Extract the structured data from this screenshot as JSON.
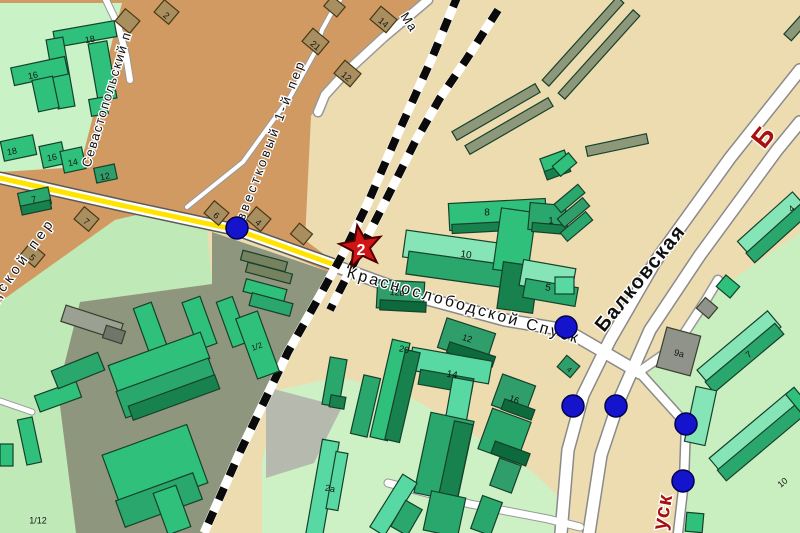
{
  "map": {
    "palette": {
      "beige": "#eddcb0",
      "orange": "#d29a63",
      "paleTL": "#c9f2c6",
      "paleBL": "#bfeab8",
      "olivezone": "#8e977d",
      "yard": "#cdf1c4",
      "graypatch": "#b5b9ae",
      "park": "#c9efc1",
      "bright": "#2fc17c",
      "mid": "#2aa76c",
      "mid2": "#2f9e6b",
      "dark": "#17824e",
      "deep": "#0d6a3c",
      "top": "#86e5b6",
      "mint": "#58d9a4",
      "olive": "#8d987b",
      "olive2": "#76815f",
      "grayb": "#9aa092",
      "gray2": "#8f938a",
      "gray3": "#70766a",
      "brown": "#a98f5f",
      "bldgStroke": "#16402b",
      "brownStroke": "#473a16",
      "rail": "#0a0a0a",
      "dotFill": "#1414cc",
      "dotStroke": "#00004d",
      "starFill": "#d11515",
      "starStroke": "#4d0000",
      "labelDark": "#101010",
      "labelRed": "#a80f0f",
      "roadYellow": "#ffe400"
    },
    "zones": [
      {
        "name": "base",
        "pts": "0,0 800,0 800,533 0,533",
        "fill": "beige"
      },
      {
        "name": "orange-quarter",
        "pts": "0,0 428,0 384,36 330,86 311,116 305,240 337,264 330,272 240,236 150,212 115,220 0,302",
        "fill": "orange"
      },
      {
        "name": "pale-green-top-left",
        "pts": "0,3 122,3 80,167 0,172",
        "fill": "paleTL"
      },
      {
        "name": "pale-green-bottom-left",
        "pts": "115,220 150,212 207,228 212,284 80,302 58,390 76,533 0,533 0,302",
        "fill": "paleBL"
      },
      {
        "name": "industrial-olive",
        "pts": "212,232 330,272 288,352 202,533 76,533 58,390 80,302 212,284",
        "fill": "olivezone"
      },
      {
        "name": "courtyard-green",
        "pts": "338,377 400,391 458,425 532,471 568,506 568,533 262,533 262,462 278,390",
        "fill": "yard"
      },
      {
        "name": "gray-lot",
        "pts": "266,387 342,407 314,463 266,478",
        "fill": "graypatch"
      },
      {
        "name": "park-green",
        "pts": "800,233 710,295 645,368 688,425 684,481 678,533 800,533",
        "fill": "park"
      }
    ],
    "roads": [
      {
        "name": "balkovskaya-left-lane",
        "pts": "800,70 730,158 655,262 610,340 583,395 568,450 561,533",
        "w": 11,
        "cw": 14,
        "casing": "#8a8a8a"
      },
      {
        "name": "balkovskaya-right-lane",
        "pts": "800,122 777,150 700,255 650,330 620,398 601,455 589,533",
        "w": 11,
        "cw": 14,
        "casing": "#8a8a8a"
      },
      {
        "name": "branch-northeast",
        "pts": "640,371 676,346 706,300 718,280",
        "w": 8,
        "cw": 11,
        "casing": "#999999"
      },
      {
        "name": "krasnoslobodskoy-spusk",
        "pts": "338,267 420,297 505,320 566,330 640,373",
        "w": 11,
        "cw": 14,
        "casing": "#8a8a8a"
      },
      {
        "name": "krasnoslobodskoy-ext",
        "pts": "640,373 686,424 684,481 678,533",
        "w": 8,
        "cw": 11,
        "casing": "#8a8a8a"
      },
      {
        "name": "yard-road",
        "pts": "388,483 470,504 548,519 580,527",
        "w": 7,
        "cw": 9,
        "casing": "#999999"
      },
      {
        "name": "gorodskoy-per-yellow",
        "pts": "0,178 120,205 237,230 338,266",
        "w": 10,
        "cw": 13,
        "casing": "#5a5a5a",
        "center": {
          "color": "roadYellow",
          "w": 5
        }
      },
      {
        "name": "izvestkovy-per",
        "pts": "187,207 243,162 290,97 315,52 322,30 333,10 340,0",
        "w": 4,
        "cw": 6,
        "casing": "#999999"
      },
      {
        "name": "ma-street",
        "pts": "428,0 383,38 345,73 325,95 318,112",
        "w": 8,
        "cw": 11,
        "casing": "#999999"
      },
      {
        "name": "stub-west",
        "pts": "0,401 32,412",
        "w": 5,
        "cw": 7,
        "casing": "#999999"
      },
      {
        "name": "sevastopolsky-top",
        "pts": "106,0 118,25 126,55 130,80",
        "w": 6,
        "cw": 8,
        "casing": "#999999"
      }
    ],
    "railways": [
      {
        "name": "railway-main",
        "pts": "458,-5 432,58 396,138 367,205 345,250 322,292 288,352 240,452 204,533",
        "w": 8,
        "dash": "13 13"
      },
      {
        "name": "railway-branch",
        "pts": "498,10 466,60 440,98 415,142 388,196 362,247 340,290 330,310",
        "w": 8,
        "dash": "13 13"
      }
    ],
    "buildings": [
      [
        54,
        26,
        62,
        16,
        -10,
        "bright"
      ],
      [
        52,
        38,
        17,
        70,
        -10,
        "bright"
      ],
      [
        93,
        42,
        19,
        58,
        -10,
        "bright"
      ],
      [
        90,
        98,
        17,
        17,
        -10,
        "bright"
      ],
      [
        12,
        62,
        55,
        18,
        -12,
        "bright"
      ],
      [
        35,
        78,
        21,
        32,
        -12,
        "bright"
      ],
      [
        2,
        138,
        33,
        20,
        -12,
        "bright"
      ],
      [
        41,
        144,
        23,
        22,
        -12,
        "bright"
      ],
      [
        62,
        149,
        22,
        22,
        -12,
        "bright"
      ],
      [
        95,
        166,
        21,
        15,
        -12,
        "mid2"
      ],
      [
        19,
        190,
        31,
        17,
        -12,
        "mid"
      ],
      [
        21,
        203,
        30,
        9,
        -12,
        "dark"
      ],
      [
        448,
        107,
        96,
        10,
        -30,
        "olive"
      ],
      [
        461,
        121,
        96,
        10,
        -30,
        "olive"
      ],
      [
        527,
        37,
        112,
        9,
        -48,
        "olive"
      ],
      [
        543,
        50,
        112,
        9,
        -48,
        "olive"
      ],
      [
        586,
        140,
        62,
        10,
        -12,
        "olive"
      ],
      [
        783,
        22,
        28,
        10,
        -48,
        "olive"
      ],
      [
        542,
        154,
        26,
        17,
        -20,
        "bright"
      ],
      [
        545,
        167,
        25,
        9,
        -20,
        "dark"
      ],
      [
        449,
        201,
        97,
        27,
        -3,
        "bright"
      ],
      [
        452,
        222,
        95,
        9,
        -3,
        "dark"
      ],
      [
        404,
        237,
        101,
        27,
        8,
        "top"
      ],
      [
        407,
        258,
        100,
        23,
        8,
        "mid"
      ],
      [
        497,
        210,
        35,
        62,
        8,
        "bright"
      ],
      [
        500,
        264,
        36,
        47,
        8,
        "dark"
      ],
      [
        529,
        204,
        36,
        27,
        5,
        "mid"
      ],
      [
        532,
        224,
        35,
        9,
        5,
        "dark"
      ],
      [
        521,
        264,
        53,
        26,
        10,
        "top"
      ],
      [
        524,
        283,
        53,
        19,
        10,
        "mid"
      ],
      [
        377,
        281,
        47,
        28,
        3,
        "mid2"
      ],
      [
        380,
        301,
        46,
        10,
        3,
        "deep"
      ],
      [
        441,
        325,
        51,
        31,
        18,
        "mid2"
      ],
      [
        447,
        349,
        48,
        11,
        18,
        "deep"
      ],
      [
        410,
        354,
        81,
        23,
        10,
        "mint"
      ],
      [
        419,
        374,
        54,
        15,
        10,
        "dark"
      ],
      [
        449,
        379,
        21,
        41,
        10,
        "mint"
      ],
      [
        496,
        379,
        35,
        33,
        20,
        "mid2"
      ],
      [
        502,
        404,
        32,
        11,
        20,
        "deep"
      ],
      [
        484,
        414,
        41,
        43,
        20,
        "mid"
      ],
      [
        492,
        447,
        37,
        13,
        20,
        "deep"
      ],
      [
        494,
        461,
        23,
        29,
        20,
        "mid2"
      ],
      [
        422,
        416,
        44,
        82,
        12,
        "mid"
      ],
      [
        446,
        422,
        19,
        80,
        12,
        "dark"
      ],
      [
        427,
        494,
        35,
        40,
        12,
        "mid"
      ],
      [
        381,
        340,
        18,
        100,
        13,
        "bright"
      ],
      [
        395,
        350,
        15,
        92,
        13,
        "dark"
      ],
      [
        357,
        376,
        17,
        60,
        13,
        "mid"
      ],
      [
        326,
        358,
        17,
        48,
        10,
        "mid"
      ],
      [
        330,
        396,
        15,
        12,
        10,
        "dark"
      ],
      [
        314,
        440,
        17,
        96,
        10,
        "mint"
      ],
      [
        331,
        452,
        12,
        58,
        10,
        "mint"
      ],
      [
        385,
        474,
        17,
        62,
        32,
        "mint"
      ],
      [
        397,
        503,
        19,
        30,
        30,
        "mid"
      ],
      [
        476,
        498,
        21,
        35,
        20,
        "mid"
      ],
      [
        554,
        193,
        31,
        11,
        -40,
        "mid"
      ],
      [
        557,
        207,
        33,
        11,
        -40,
        "mid2"
      ],
      [
        560,
        221,
        33,
        11,
        -40,
        "mid"
      ],
      [
        554,
        158,
        21,
        13,
        -40,
        "bright"
      ],
      [
        555,
        277,
        19,
        17,
        0,
        "mint"
      ],
      [
        560,
        359,
        17,
        15,
        40,
        "mid2"
      ],
      [
        661,
        331,
        35,
        41,
        15,
        "gray2"
      ],
      [
        699,
        301,
        16,
        14,
        40,
        "gray2"
      ],
      [
        719,
        279,
        18,
        15,
        40,
        "bright"
      ],
      [
        735,
        214,
        74,
        21,
        -42,
        "top"
      ],
      [
        741,
        227,
        73,
        13,
        -42,
        "mid"
      ],
      [
        693,
        338,
        92,
        21,
        -40,
        "top"
      ],
      [
        699,
        351,
        91,
        14,
        -40,
        "mid"
      ],
      [
        690,
        388,
        21,
        56,
        12,
        "top"
      ],
      [
        704,
        423,
        102,
        21,
        -40,
        "top"
      ],
      [
        710,
        436,
        101,
        14,
        -40,
        "mid"
      ],
      [
        792,
        388,
        11,
        24,
        -40,
        "bright"
      ],
      [
        686,
        513,
        17,
        19,
        5,
        "bright"
      ],
      [
        62,
        314,
        60,
        17,
        18,
        "grayb"
      ],
      [
        104,
        328,
        20,
        13,
        18,
        "gray3"
      ],
      [
        141,
        304,
        19,
        48,
        -20,
        "bright"
      ],
      [
        190,
        298,
        19,
        50,
        -20,
        "bright"
      ],
      [
        224,
        298,
        17,
        48,
        -20,
        "bright"
      ],
      [
        246,
        313,
        23,
        64,
        -20,
        "bright"
      ],
      [
        110,
        348,
        98,
        28,
        -20,
        "bright"
      ],
      [
        118,
        374,
        98,
        28,
        -20,
        "mid"
      ],
      [
        128,
        390,
        92,
        15,
        -20,
        "dark"
      ],
      [
        36,
        388,
        44,
        17,
        -20,
        "bright"
      ],
      [
        22,
        418,
        15,
        46,
        -12,
        "bright"
      ],
      [
        0,
        444,
        13,
        22,
        0,
        "bright"
      ],
      [
        53,
        361,
        50,
        19,
        -22,
        "mid"
      ],
      [
        110,
        438,
        90,
        62,
        -20,
        "bright"
      ],
      [
        118,
        486,
        82,
        28,
        -20,
        "mid"
      ],
      [
        160,
        488,
        24,
        44,
        -20,
        "bright"
      ],
      [
        241,
        256,
        46,
        10,
        15,
        "olive2"
      ],
      [
        246,
        268,
        46,
        10,
        15,
        "olive2"
      ],
      [
        244,
        284,
        42,
        13,
        15,
        "bright"
      ],
      [
        250,
        298,
        42,
        13,
        15,
        "mid"
      ],
      [
        118,
        13,
        19,
        16,
        40,
        "brown"
      ],
      [
        157,
        4,
        19,
        16,
        40,
        "brown"
      ],
      [
        305,
        33,
        21,
        17,
        40,
        "brown"
      ],
      [
        373,
        11,
        21,
        17,
        40,
        "brown"
      ],
      [
        337,
        65,
        21,
        17,
        40,
        "brown"
      ],
      [
        77,
        211,
        19,
        16,
        40,
        "brown"
      ],
      [
        23,
        247,
        19,
        16,
        40,
        "brown"
      ],
      [
        207,
        205,
        19,
        16,
        40,
        "brown"
      ],
      [
        249,
        211,
        19,
        16,
        40,
        "brown"
      ],
      [
        293,
        227,
        17,
        14,
        40,
        "brown"
      ],
      [
        326,
        0,
        17,
        13,
        40,
        "brown"
      ]
    ],
    "street_labels": [
      {
        "t": "Севастопольский п",
        "x": 90,
        "y": 168,
        "s": 13,
        "r": -73,
        "ls": 1.5,
        "c": "labelDark",
        "b": 400
      },
      {
        "t": "Известковый 1-й пер",
        "x": 240,
        "y": 232,
        "s": 13,
        "r": -69,
        "ls": 3,
        "c": "labelDark",
        "b": 400
      },
      {
        "t": "Ма",
        "x": 400,
        "y": 16,
        "s": 13,
        "r": 57,
        "ls": 1,
        "c": "labelDark",
        "b": 400
      },
      {
        "t": "одской пер",
        "x": -10,
        "y": 312,
        "s": 14,
        "r": -54,
        "ls": 4,
        "c": "labelDark",
        "b": 400
      },
      {
        "t": "Краснослободской Спуск",
        "x": 346,
        "y": 277,
        "s": 16,
        "r": 16,
        "ls": 2.5,
        "c": "labelDark",
        "b": 400
      },
      {
        "t": "Балковская",
        "x": 604,
        "y": 333,
        "s": 20,
        "r": -51,
        "ls": 1.5,
        "c": "labelDark",
        "b": 600
      },
      {
        "t": "Б",
        "x": 764,
        "y": 150,
        "s": 27,
        "r": -51,
        "ls": 0,
        "c": "labelRed",
        "b": 700
      },
      {
        "t": "уск",
        "x": 666,
        "y": 531,
        "s": 21,
        "r": -80,
        "ls": 1,
        "c": "labelRed",
        "b": 700
      }
    ],
    "number_labels": [
      {
        "t": "18",
        "x": 90,
        "y": 40,
        "r": -10
      },
      {
        "t": "16",
        "x": 33,
        "y": 76,
        "r": -12
      },
      {
        "t": "18",
        "x": 12,
        "y": 152,
        "r": -12
      },
      {
        "t": "16",
        "x": 52,
        "y": 158,
        "r": -12
      },
      {
        "t": "14",
        "x": 73,
        "y": 163,
        "r": -12
      },
      {
        "t": "12",
        "x": 105,
        "y": 177,
        "r": -12
      },
      {
        "t": "7",
        "x": 34,
        "y": 200,
        "r": -12
      },
      {
        "t": "2",
        "x": 166,
        "y": 16,
        "r": 40
      },
      {
        "t": "21",
        "x": 315,
        "y": 46,
        "r": 40
      },
      {
        "t": "14",
        "x": 383,
        "y": 23,
        "r": 40
      },
      {
        "t": "12",
        "x": 346,
        "y": 77,
        "r": 40
      },
      {
        "t": "7",
        "x": 86,
        "y": 222,
        "r": 40
      },
      {
        "t": "5",
        "x": 32,
        "y": 258,
        "r": 40
      },
      {
        "t": "6",
        "x": 216,
        "y": 216,
        "r": 40
      },
      {
        "t": "4",
        "x": 258,
        "y": 223,
        "r": 40
      },
      {
        "t": "8",
        "x": 487,
        "y": 213,
        "r": 0,
        "s": 10
      },
      {
        "t": "10",
        "x": 466,
        "y": 255,
        "r": 8,
        "s": 10
      },
      {
        "t": "1",
        "x": 551,
        "y": 221,
        "r": 0
      },
      {
        "t": "5",
        "x": 548,
        "y": 288,
        "r": 10,
        "s": 10
      },
      {
        "t": "12в",
        "x": 397,
        "y": 293,
        "r": 3
      },
      {
        "t": "12",
        "x": 467,
        "y": 339,
        "r": 18
      },
      {
        "t": "14",
        "x": 452,
        "y": 375,
        "r": 10,
        "s": 10
      },
      {
        "t": "16",
        "x": 514,
        "y": 400,
        "r": 20
      },
      {
        "t": "20",
        "x": 404,
        "y": 350,
        "r": 13
      },
      {
        "t": "2а",
        "x": 330,
        "y": 489,
        "r": 10
      },
      {
        "t": "1/2",
        "x": 257,
        "y": 347,
        "r": -20,
        "s": 8
      },
      {
        "t": "1/12",
        "x": 38,
        "y": 521,
        "r": 0
      },
      {
        "t": "9а",
        "x": 679,
        "y": 354,
        "r": 15
      },
      {
        "t": "4",
        "x": 569,
        "y": 370,
        "r": 40,
        "s": 7
      },
      {
        "t": "4",
        "x": 792,
        "y": 209,
        "r": -42
      },
      {
        "t": "7",
        "x": 749,
        "y": 355,
        "r": -40
      },
      {
        "t": "10",
        "x": 783,
        "y": 483,
        "r": -40
      }
    ],
    "star": {
      "x": 361,
      "y": 247,
      "R": 22,
      "r2": 9,
      "rot": -10,
      "label": "2",
      "label_size": 16
    },
    "dots": {
      "r": 11,
      "points": [
        [
          237,
          228
        ],
        [
          566,
          327
        ],
        [
          573,
          406
        ],
        [
          616,
          406
        ],
        [
          686,
          424
        ],
        [
          683,
          481
        ]
      ]
    }
  }
}
